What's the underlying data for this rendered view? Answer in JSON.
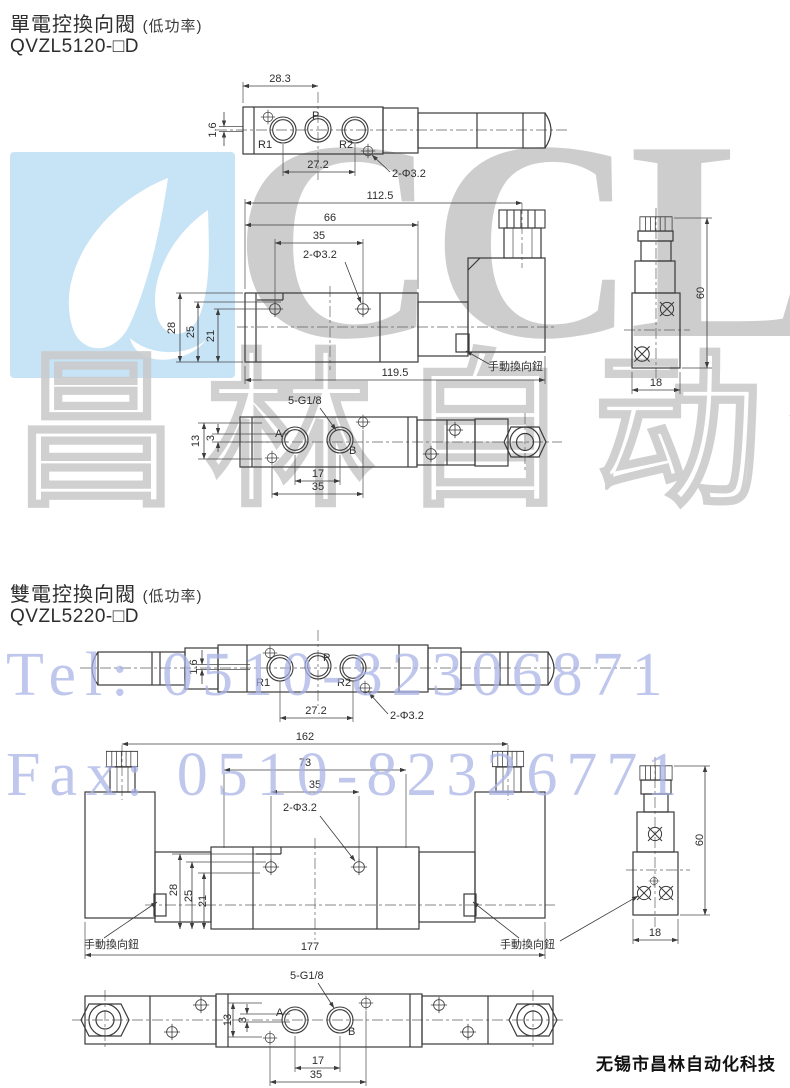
{
  "page": {
    "footer": "无锡市昌林自动化科技"
  },
  "watermarks": {
    "brand": "CCLair",
    "brand_cn": "昌林自动化",
    "tel": "Tel: 0510-82306871",
    "fax": "Fax: 0510-82326771",
    "logo_bg_color": "#c7e3f6",
    "blue_text_color": "#a9b2e6",
    "gray_mark_color": "#b0b0b0"
  },
  "sections": [
    {
      "title": "單電控換向閥",
      "power_note": "(低功率)",
      "model": "QVZL5120-□D",
      "top_view": {
        "dim_width": "28.3",
        "dim_offset": "1.6",
        "dim_pitch": "27.2",
        "dim_holes": "2-Φ3.2",
        "port_r1": "R1",
        "port_p": "P",
        "port_r2": "R2"
      },
      "front_view": {
        "dim_overall": "112.5",
        "dim_body": "66",
        "dim_span": "35",
        "dim_holes": "2-Φ3.2",
        "dim_h28": "28",
        "dim_h25": "25",
        "dim_h21": "21",
        "dim_total": "119.5",
        "label_manual": "手動換向鈕"
      },
      "side_view": {
        "dim_height": "60",
        "dim_width": "18"
      },
      "bottom_view": {
        "label_thread": "5-G1/8",
        "dim_h13": "13",
        "dim_h3": "3",
        "port_a": "A",
        "port_b": "B",
        "dim_17": "17",
        "dim_35": "35"
      }
    },
    {
      "title": "雙電控換向閥",
      "power_note": "(低功率)",
      "model": "QVZL5220-□D",
      "top_view": {
        "dim_offset": "1.6",
        "dim_pitch": "27.2",
        "dim_holes": "2-Φ3.2",
        "port_r1": "R1",
        "port_p": "P",
        "port_r2": "R2"
      },
      "front_view": {
        "dim_overall": "162",
        "dim_body": "73",
        "dim_span": "35",
        "dim_holes": "2-Φ3.2",
        "dim_h28": "28",
        "dim_h25": "25",
        "dim_h21": "21",
        "dim_total": "177",
        "label_manual_left": "手動換向鈕",
        "label_manual_right": "手動換向鈕"
      },
      "side_view": {
        "dim_height": "60",
        "dim_width": "18"
      },
      "bottom_view": {
        "label_thread": "5-G1/8",
        "dim_h13": "13",
        "dim_h3": "3",
        "port_a": "A",
        "port_b": "B",
        "dim_17": "17",
        "dim_35": "35"
      }
    }
  ]
}
